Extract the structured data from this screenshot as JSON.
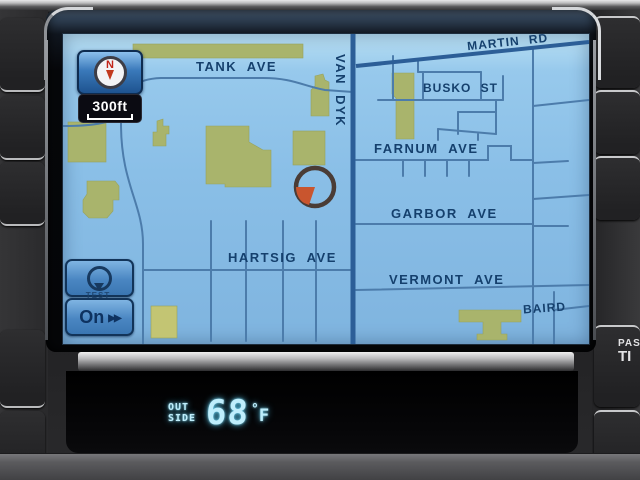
{
  "map": {
    "compass_letter": "N",
    "scale": "300ft",
    "streets": {
      "tank": "TANK AVE",
      "van_dyke": "VAN DYK",
      "martin": "MARTIN RD",
      "busko": "BUSKO ST",
      "farnum": "FARNUM AVE",
      "garbor": "GARBOR AVE",
      "vermont": "VERMONT AVE",
      "baird": "BAIRD",
      "hartsig": "HARTSIG AVE"
    },
    "buttons": {
      "caption": "TEST",
      "audio_label": "On",
      "audio_arrows": "▶▶"
    }
  },
  "climate": {
    "line1": "OUT",
    "line2": "SIDE",
    "temperature": "68",
    "degree": "°",
    "unit": "F"
  },
  "dash": {
    "pass_line1": "PAS",
    "pass_line2": "TI"
  },
  "colors": {
    "map_background": "#8abfe7",
    "road_minor": "#4c7cab",
    "road_major": "#2c5e97",
    "building": "#a9b46c",
    "street_label": "#15406d",
    "marker_wedge": "#c9552e",
    "vfd_cyan": "#bfeefc",
    "button_blue": "#4a86c2"
  }
}
